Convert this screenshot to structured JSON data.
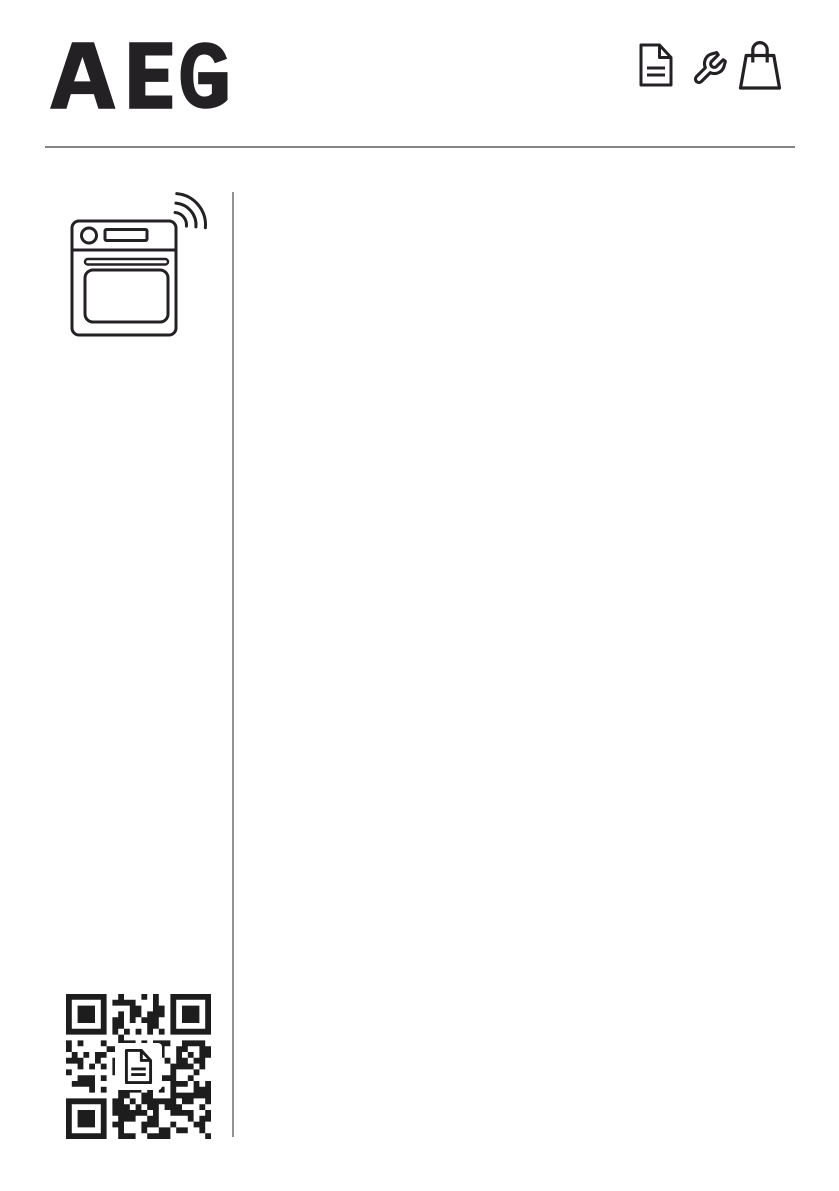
{
  "page": {
    "title": "AEG appliance user manual cover page",
    "background": "#ffffff",
    "ink": "#242124",
    "rule_color": "#848484",
    "vertical_rule_color": "#929292"
  },
  "header": {
    "brand_logo": "AEG",
    "icons": [
      {
        "name": "document-icon"
      },
      {
        "name": "wrench-icon"
      },
      {
        "name": "shopping-bag-icon"
      }
    ]
  },
  "content": {
    "appliance_icon": {
      "name": "oven-wifi-icon",
      "depicts": "built-in oven with Wi-Fi signal"
    },
    "qr_code": {
      "name": "qr-code",
      "modules": 25,
      "pattern_seed": 987654321,
      "module_color": "#1d1d1d",
      "center_icon": "document-icon"
    }
  }
}
